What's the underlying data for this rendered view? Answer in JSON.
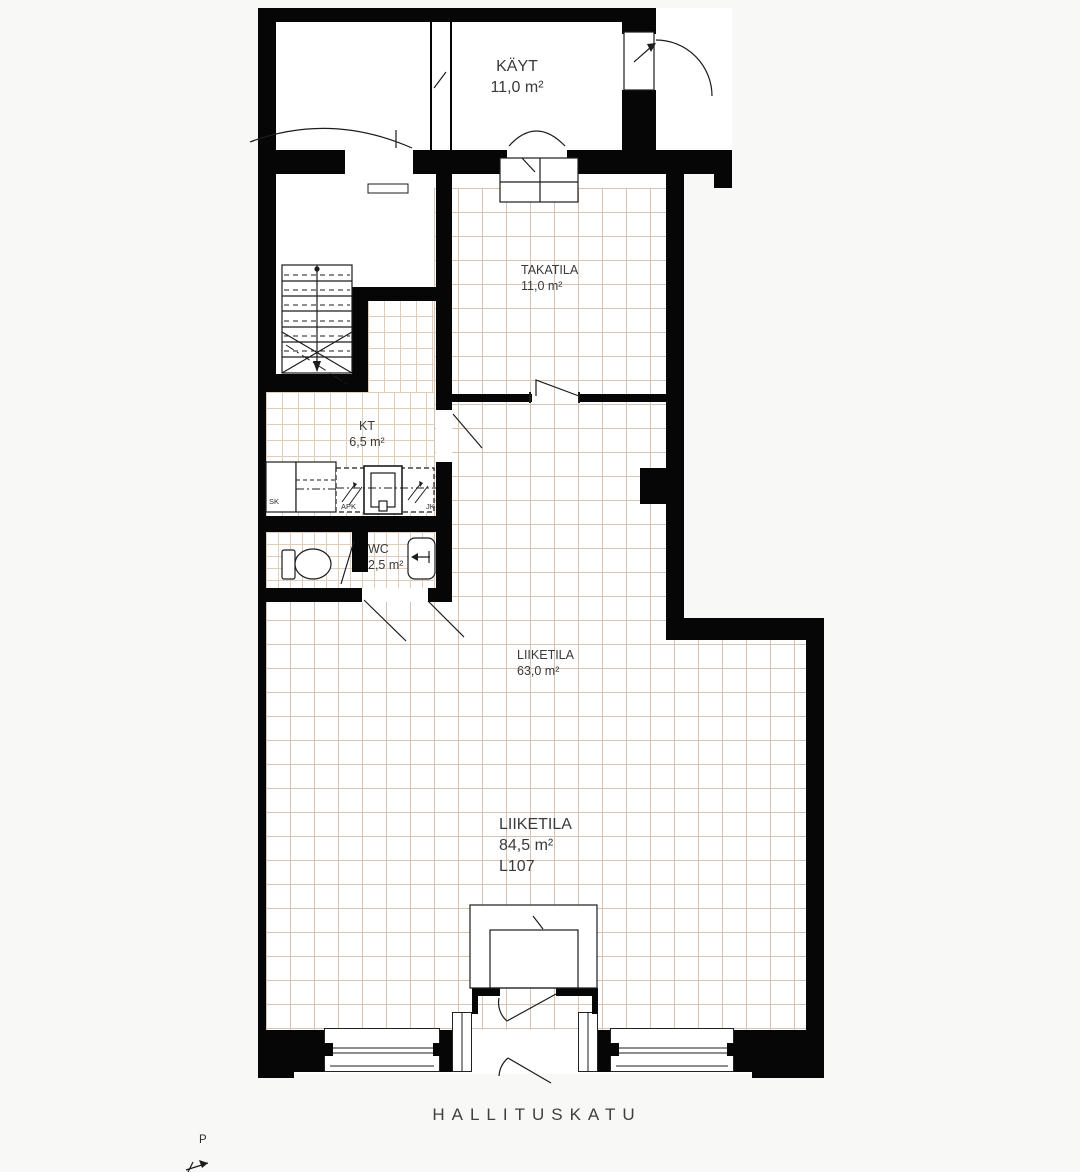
{
  "plan": {
    "title": "floor-plan",
    "rooms": {
      "kayt": {
        "name": "KÄYT",
        "area": "11,0 m²"
      },
      "takatila": {
        "name": "TAKATILA",
        "area": "11,0 m²"
      },
      "kt": {
        "name": "KT",
        "area": "6,5 m²"
      },
      "wc": {
        "name": "WC",
        "area": "2,5 m²"
      },
      "liiketila_back": {
        "name": "LIIKETILA",
        "area": "63,0 m²"
      },
      "liiketila_main": {
        "name": "LIIKETILA",
        "area": "84,5 m²",
        "unit_code": "L107"
      }
    },
    "fixtures": {
      "sk_label": "SK",
      "apk_label": "APK",
      "jk_label": "JK"
    },
    "street_name": "HALLITUSKATU",
    "north_marker": "P",
    "icons": [
      "stairs-icon",
      "toilet-icon",
      "washbasin-icon",
      "sink-icon",
      "door-swing-icon",
      "north-arrow-icon"
    ],
    "colors": {
      "wall": "#060606",
      "tile_line": "#d8c2b0",
      "floor": "#ffffff",
      "background": "#f8f8f7",
      "text": "#3a3a3a"
    }
  }
}
